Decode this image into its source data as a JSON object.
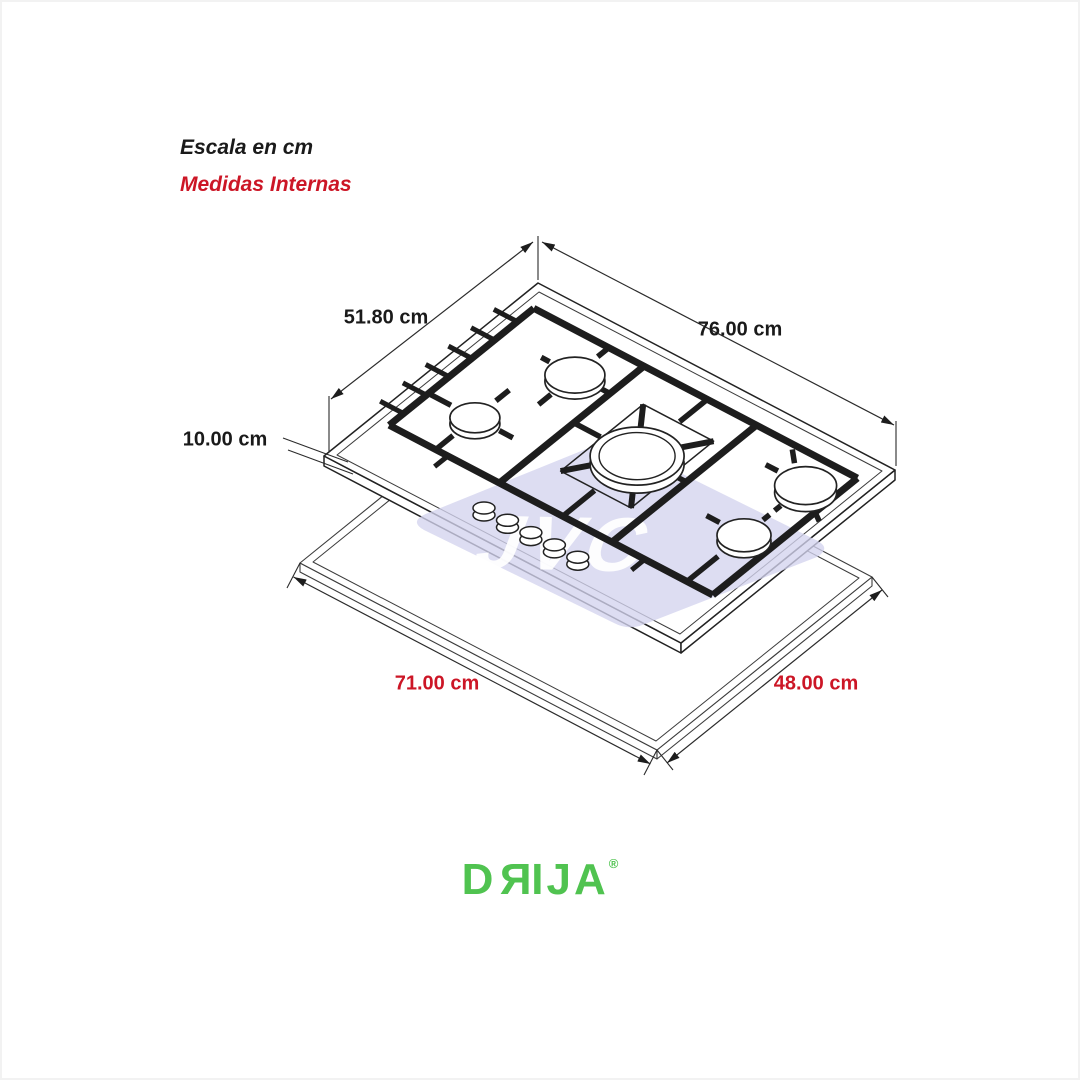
{
  "header": {
    "scale_label": "Escala en cm",
    "internal_label": "Medidas Internas",
    "internal_color": "#cc1626"
  },
  "dimensions": {
    "top_depth": {
      "value": "51.80 cm",
      "color": "#1a1a1a"
    },
    "top_width": {
      "value": "76.00 cm",
      "color": "#1a1a1a"
    },
    "body_height": {
      "value": "10.00 cm",
      "color": "#1a1a1a"
    },
    "cutout_width": {
      "value": "71.00 cm",
      "color": "#cc1626"
    },
    "cutout_depth": {
      "value": "48.00 cm",
      "color": "#cc1626"
    }
  },
  "watermark": {
    "text": "JVC",
    "tile_color": "#d3d3ee",
    "text_color": "#ffffff"
  },
  "logo": {
    "text": "DRIJA",
    "letters": [
      "D",
      "R",
      "I",
      "J",
      "A"
    ],
    "registered": "®",
    "color": "#50c350"
  },
  "diagram": {
    "subject": "isometric drawing of a 5-burner gas cooktop above its countertop cutout",
    "line_color": "#1d1d1d"
  }
}
